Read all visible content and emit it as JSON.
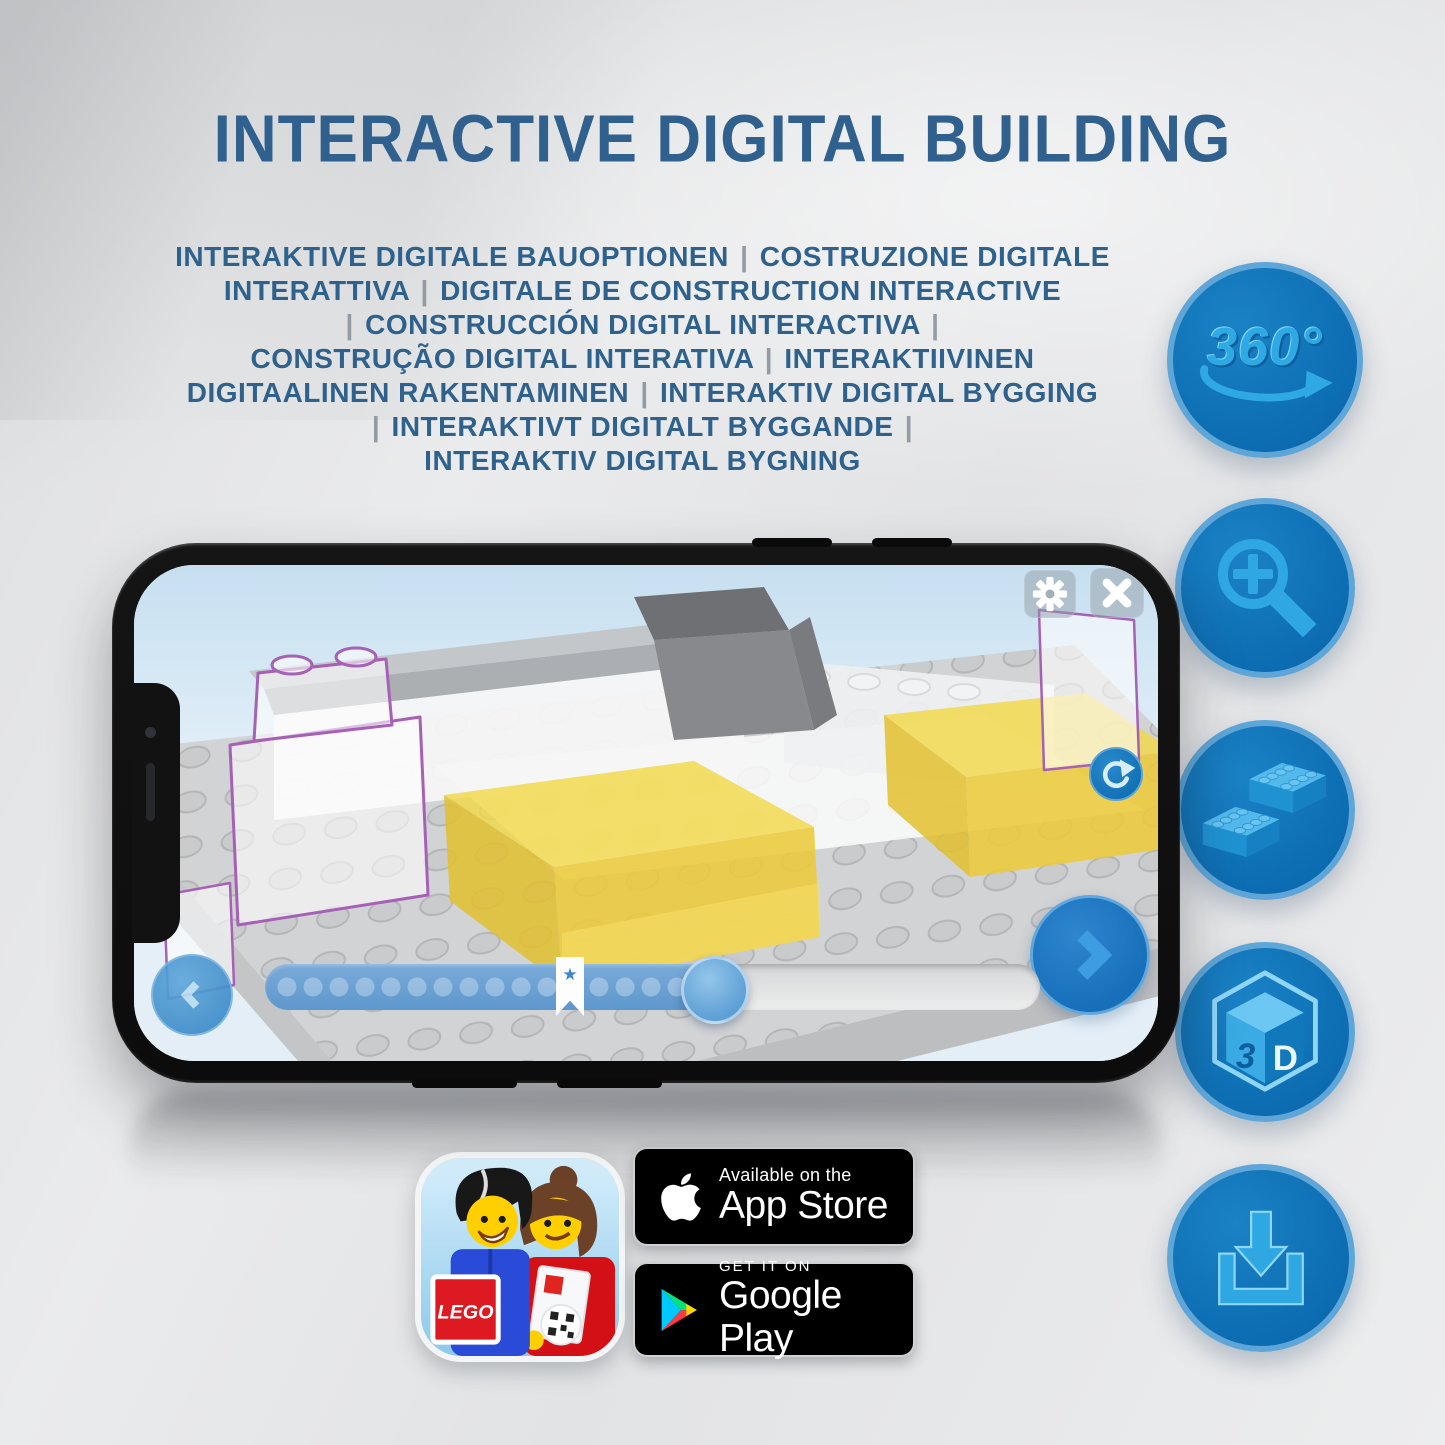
{
  "title": "INTERACTIVE DIGITAL BUILDING",
  "subtitle_lines": [
    "INTERAKTIVE DIGITALE BAUOPTIONEN | COSTRUZIONE DIGITALE",
    "INTERATTIVA | DIGITALE DE CONSTRUCTION INTERACTIVE",
    "| CONSTRUCCIÓN DIGITAL INTERACTIVA |",
    "CONSTRUÇÃO DIGITAL INTERATIVA | INTERAKTIIVINEN",
    "DIGITAALINEN RAKENTAMINEN | INTERAKTIV DIGITAL BYGGING",
    "| INTERAKTIVT DIGITALT BYGGANDE |",
    "INTERAKTIV DIGITAL BYGNING"
  ],
  "feature_rail": {
    "rotation_360": {
      "label": "360°"
    },
    "cube_3d": {
      "face_left": "3",
      "face_right": "D"
    }
  },
  "slider": {
    "bookmark_star": "★"
  },
  "badges": {
    "lego_app": {
      "logo_text": "LEGO"
    },
    "app_store": {
      "tagline": "Available on the",
      "store_name": "App Store"
    },
    "google_play": {
      "tagline": "GET IT ON",
      "store_name": "Google Play"
    }
  },
  "colors": {
    "title_blue": "#30618e",
    "pipe_gray": "#949ca3",
    "circle_blue": "#0e6fb4",
    "glyph_blue": "#2ea7e2",
    "brick_yellow": "#f0d54b",
    "outline_purple": "#a661b6",
    "screen_blue": "#dfeef7"
  }
}
